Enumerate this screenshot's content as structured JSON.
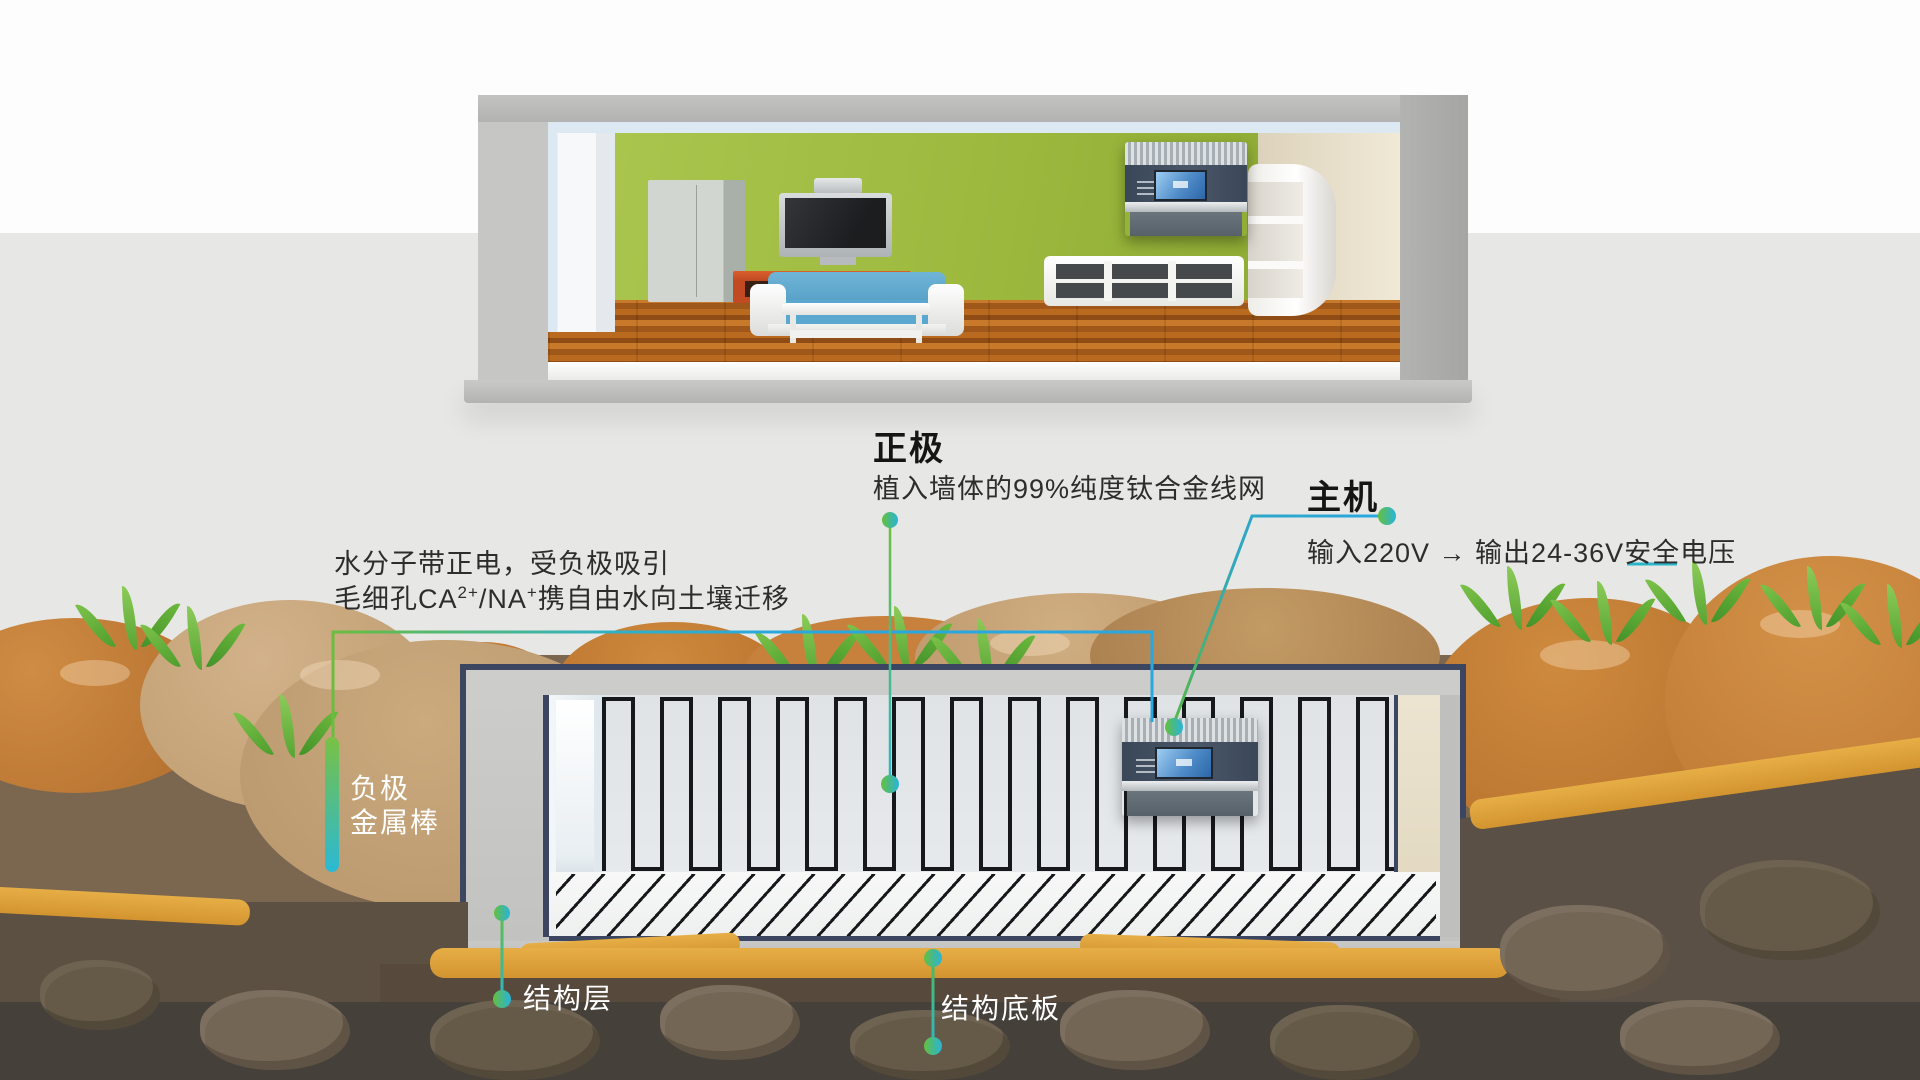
{
  "labels": {
    "positive": {
      "title": "正极",
      "subtitle": "植入墙体的99%纯度钛合金线网"
    },
    "host": {
      "title": "主机",
      "subtitle": "输入220V → 输出24-36V安全电压"
    },
    "water": {
      "line1": "水分子带正电，受负极吸引",
      "line2_pre": "毛细孔CA",
      "line2_sup1": "2+",
      "line2_mid": "/NA",
      "line2_sup2": "+",
      "line2_post": "携自由水向土壤迁移"
    },
    "negative": {
      "line1": "负极",
      "line2": "金属棒"
    },
    "structure_layer": "结构层",
    "structure_slab": "结构底板"
  },
  "palette": {
    "leader_green": "#62bd3f",
    "leader_blue": "#29a7e0",
    "leader_teal": "#2bb9d5",
    "outline_navy": "#3c4660",
    "wall_green": "#9cb83d",
    "soil_orange": "#c8803a",
    "soil_tan": "#c5a478",
    "soil_dark": "#5c5043",
    "gold_ridge": "#dd9c35",
    "grass_green": "#63b438",
    "background_band": "#e7e7e5"
  }
}
